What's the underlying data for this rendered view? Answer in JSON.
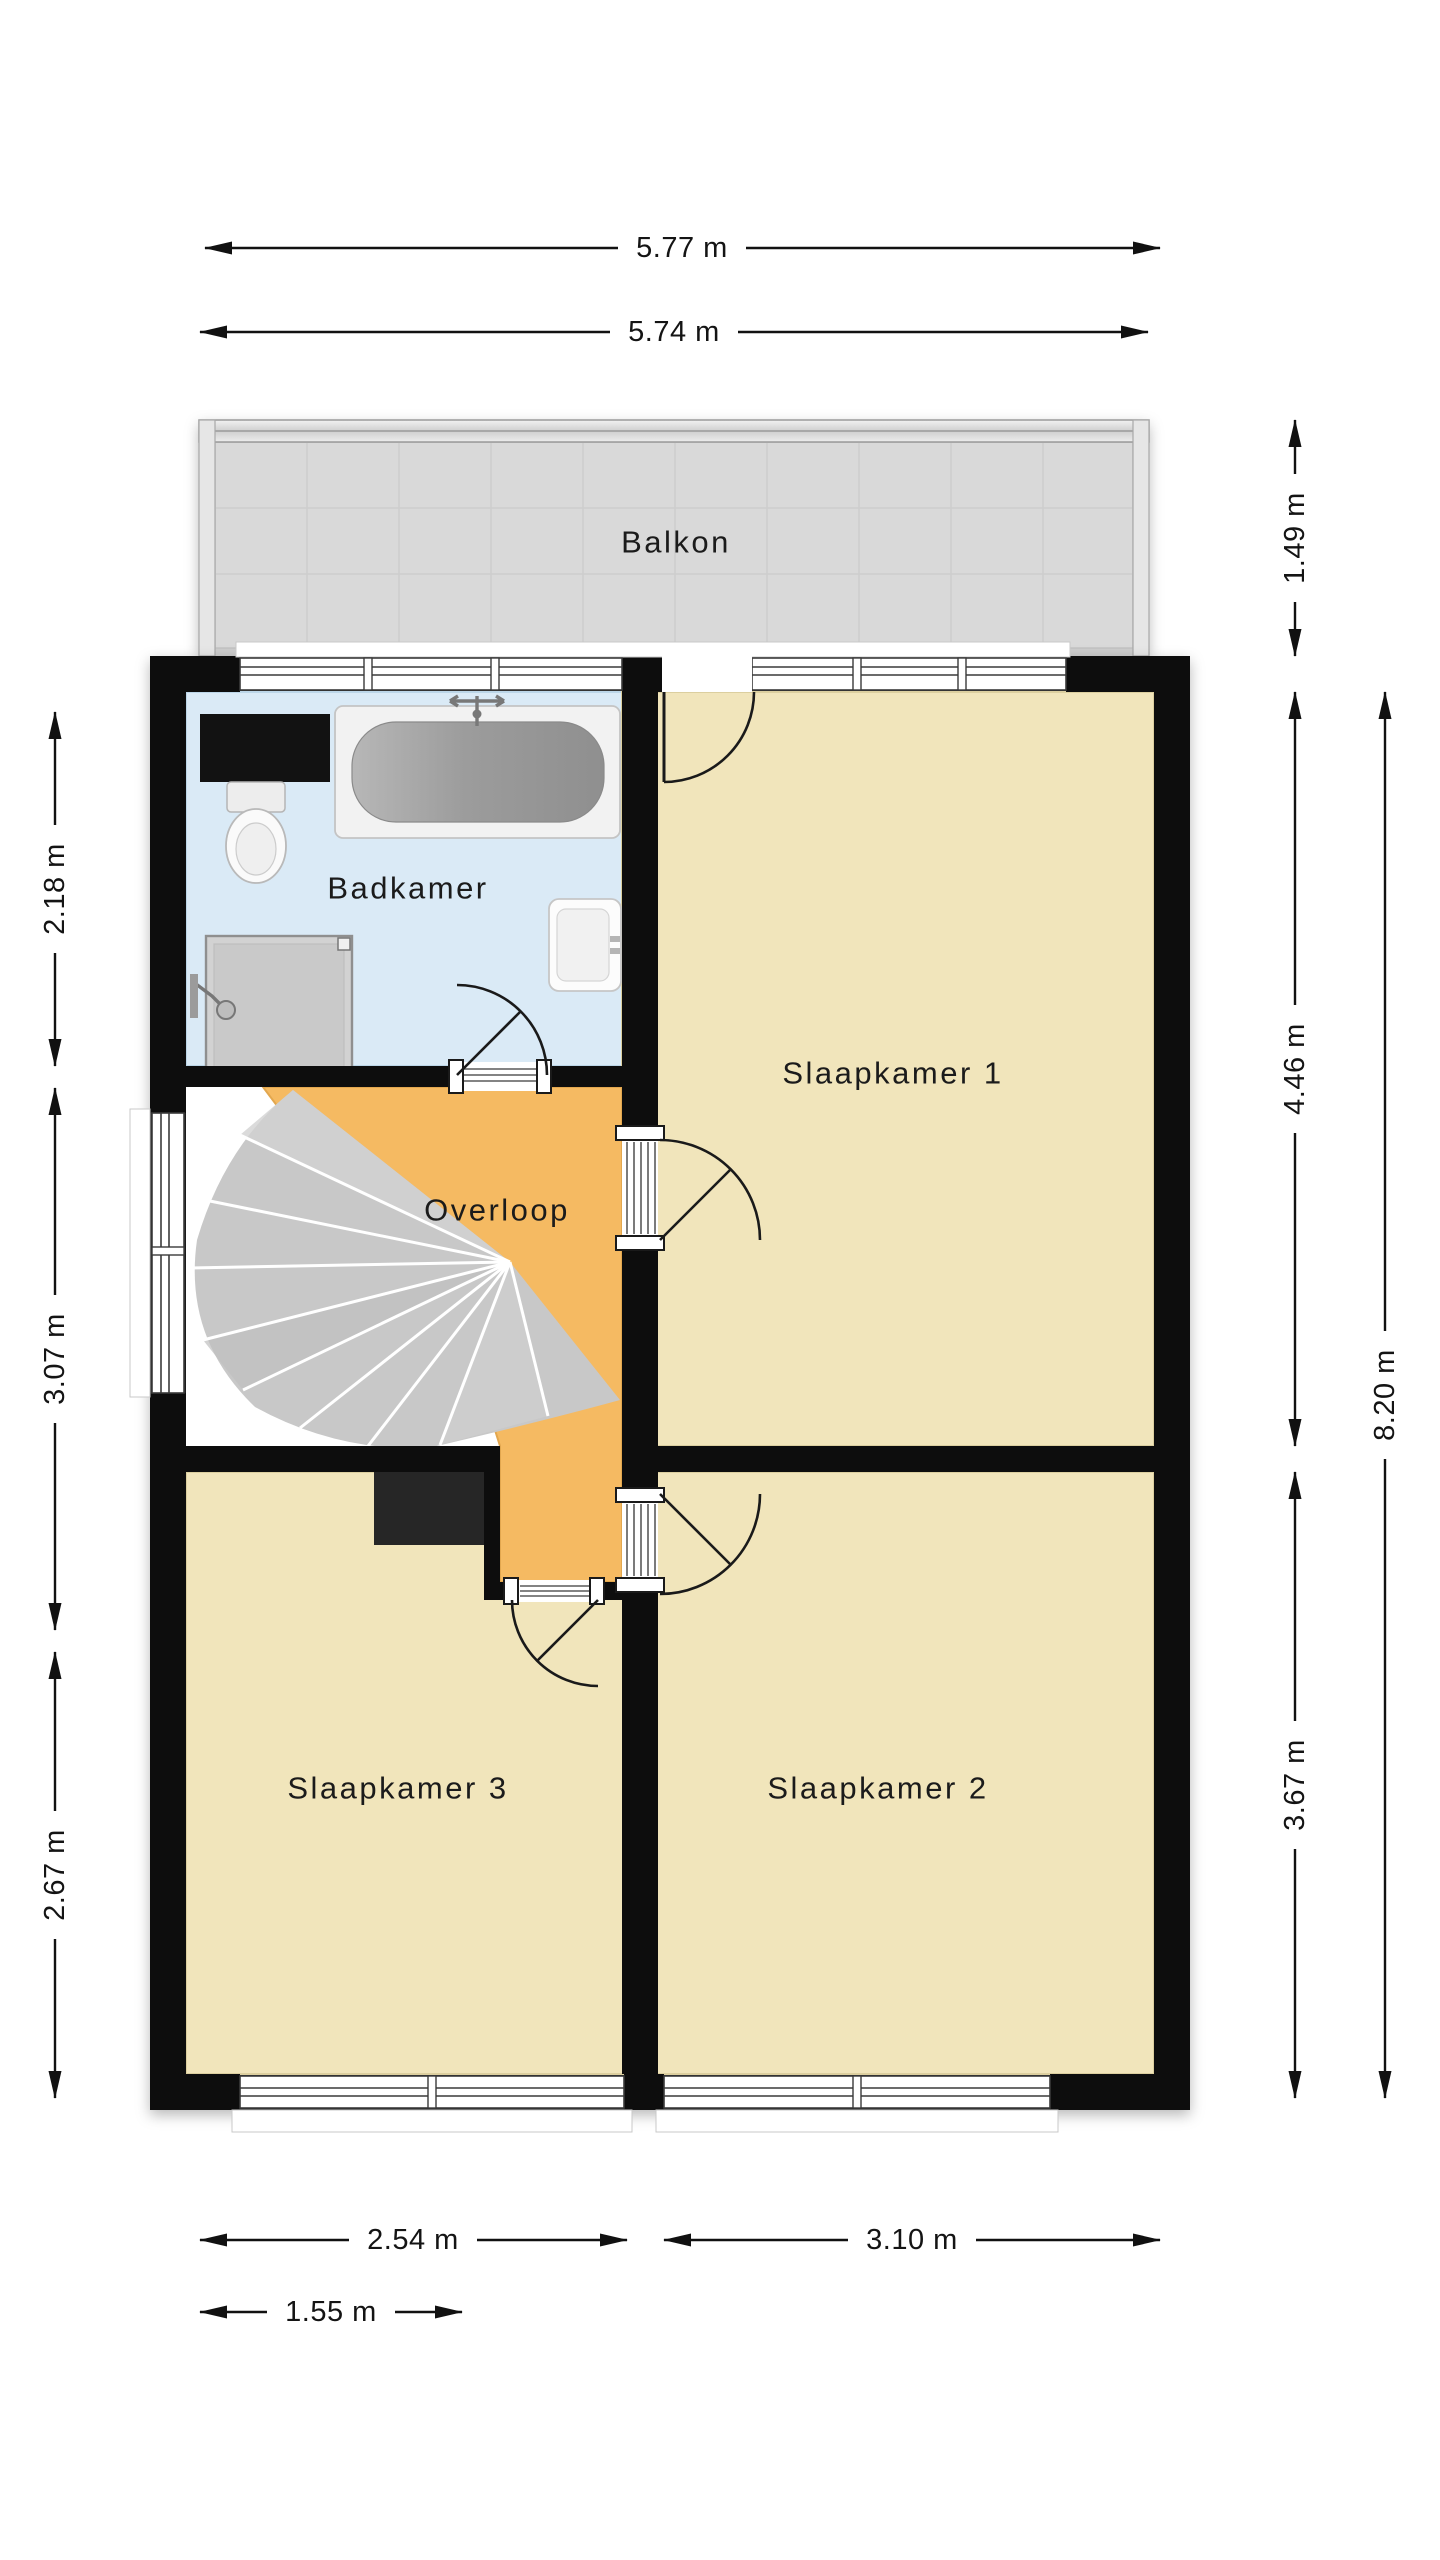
{
  "floorplan": {
    "balcony": {
      "label": "Balkon"
    },
    "rooms": {
      "bathroom": {
        "label": "Badkamer"
      },
      "bedroom1": {
        "label": "Slaapkamer 1"
      },
      "bedroom2": {
        "label": "Slaapkamer 2"
      },
      "bedroom3": {
        "label": "Slaapkamer 3"
      },
      "landing": {
        "label": "Overloop"
      }
    },
    "dimensions": {
      "top_outer": "5.77 m",
      "top_inner": "5.74 m",
      "left_bathroom": "2.18 m",
      "left_stairs": "3.07 m",
      "left_bedroom3": "2.67 m",
      "right_balcony": "1.49 m",
      "right_bedroom1": "4.46 m",
      "right_bedroom2": "3.67 m",
      "right_total": "8.20 m",
      "bottom_bedroom3": "2.54 m",
      "bottom_bedroom2": "3.10 m",
      "bottom_stairwell": "1.55 m"
    }
  },
  "colors": {
    "room-beige": "#f1e5bb",
    "room-beige-edge": "#dccf9f",
    "landing-orange": "#f5ba62",
    "landing-orange-edge": "#e2a74f",
    "bathroom-blue": "#daeaf6",
    "bathroom-blue-edge": "#bcd6e8",
    "balcony-gray": "#d9d9d9",
    "balcony-line": "#cdcdcd",
    "stair-gray": "#c8c8c8",
    "chimney-gray": "#262626",
    "wall-black": "#0d0d0d"
  }
}
